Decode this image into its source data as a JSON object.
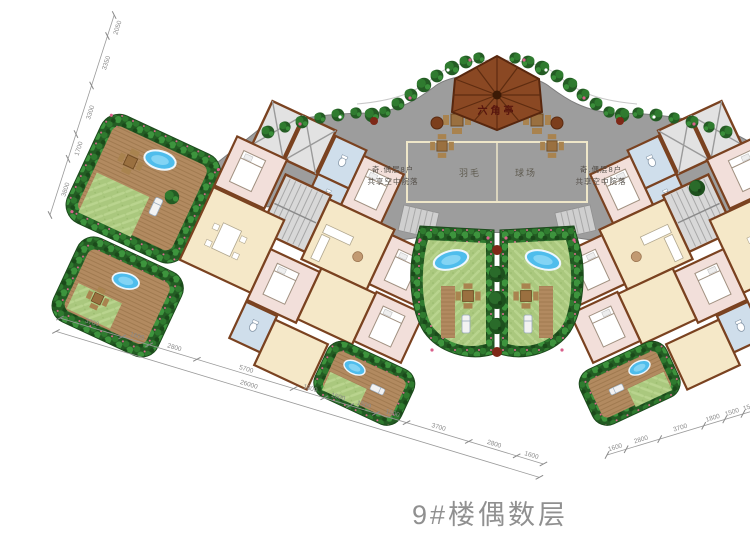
{
  "title": {
    "text": "9#楼偶数层"
  },
  "pavilion": {
    "label": "六角亭"
  },
  "badminton_court": {
    "label_left": "羽毛",
    "label_right": "球场"
  },
  "notes": {
    "left": {
      "line1": "奇.偶层8户",
      "line2": "共享空中院落"
    },
    "right": {
      "line1": "奇.偶层8户",
      "line2": "共享空中院落"
    }
  },
  "dimensions": {
    "top_left": {
      "values": [
        "2050",
        "3350",
        "3300",
        "1700",
        "3800"
      ]
    },
    "bottom_left": {
      "values": [
        "3700",
        "1600",
        "2800",
        "5700",
        "1800",
        "1500",
        "1500",
        "1800",
        "3700",
        "2800",
        "1600"
      ],
      "total": "26000"
    },
    "bottom_right": {
      "values": [
        "1600",
        "2800",
        "3700",
        "1800",
        "1500",
        "1500",
        "1800",
        "5700",
        "2800",
        "1600",
        "3700"
      ]
    }
  },
  "colors": {
    "deck": "#9d9d9d",
    "court_line": "#efe7c9",
    "roof": "#8a4823",
    "shrub": "#235c23",
    "lawn": "#aac87e",
    "pool": "#4fbdec",
    "living": "#f5e8c8",
    "bedroom": "#f2dfda",
    "bathroom": "#cfdeeb",
    "wall": "#7a4220",
    "dimension_text": "#8a8a8a",
    "title_text": "#909090"
  }
}
